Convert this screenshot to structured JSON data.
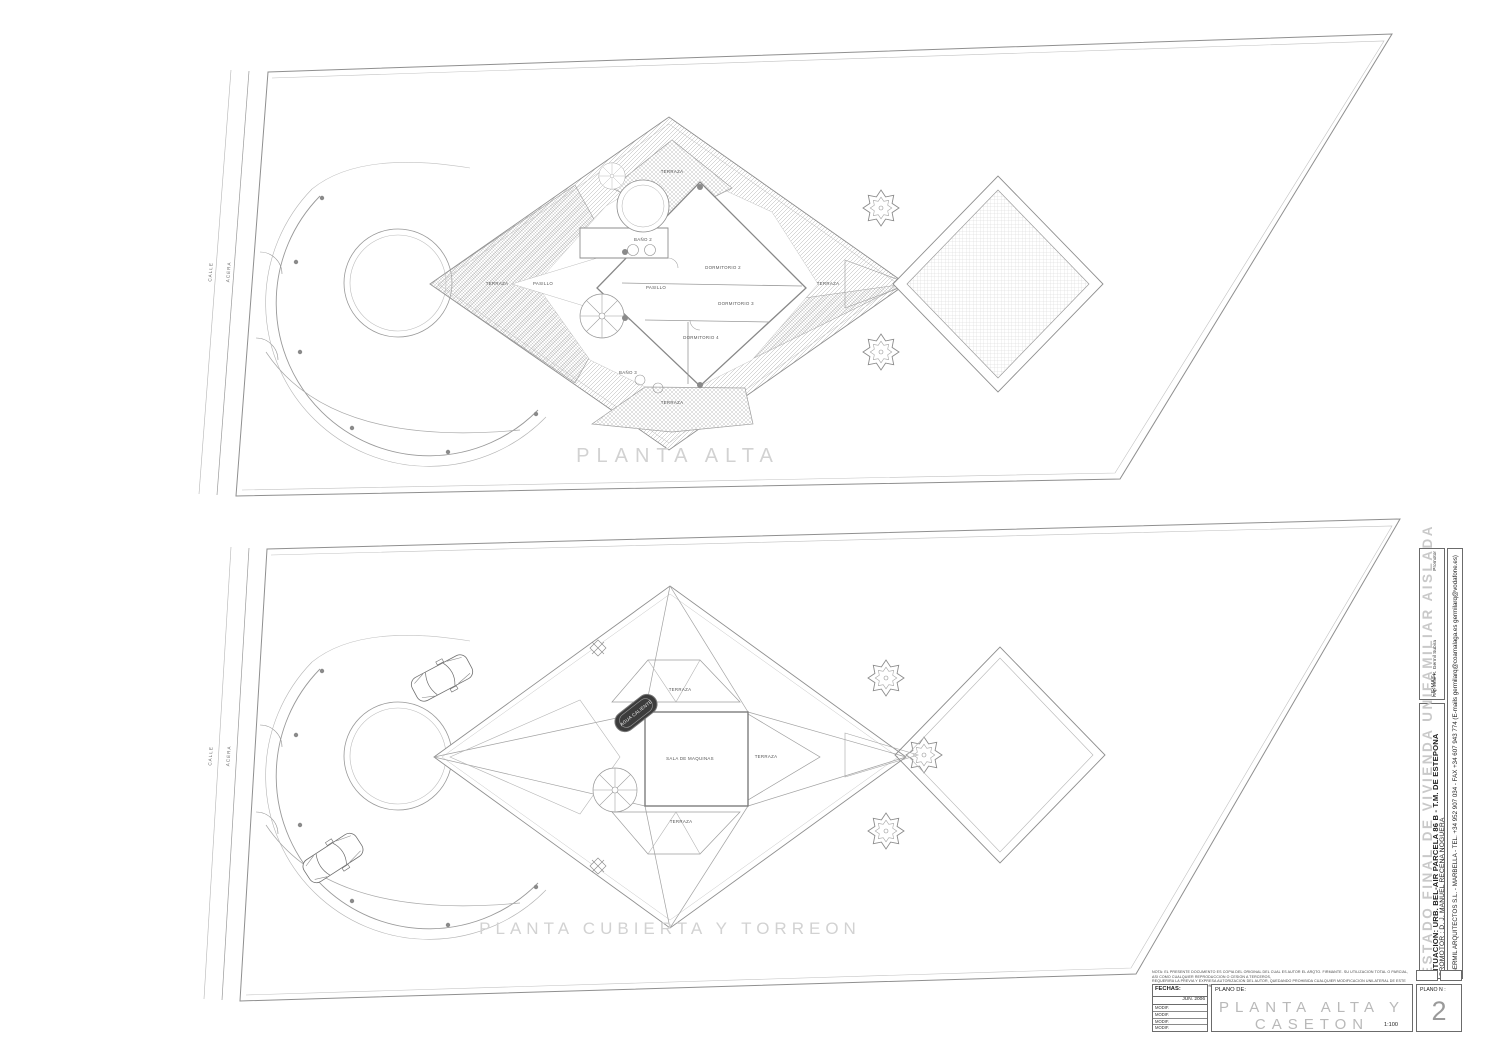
{
  "plans": {
    "upper": {
      "title": "PLANTA ALTA",
      "calle": "CALLE",
      "acera": "ACERA",
      "labels": {
        "terraza_left": "TERRAZA",
        "terraza_top": "TERRAZA",
        "terraza_right": "TERRAZA",
        "terraza_bottom": "TERRAZA",
        "pasillo_left": "PASILLO",
        "pasillo_center": "PASILLO",
        "bano2": "BAÑO 2",
        "bano3": "BAÑO 3",
        "dormitorio2": "DORMITORIO 2",
        "dormitorio3": "DORMITORIO 3",
        "dormitorio4": "DORMITORIO 4"
      }
    },
    "lower": {
      "title": "PLANTA CUBIERTA Y TORREON",
      "calle": "CALLE",
      "acera": "ACERA",
      "labels": {
        "terraza_top": "TERRAZA",
        "terraza_right": "TERRAZA",
        "terraza_bottom": "TERRAZA",
        "sala_maquinas": "SALA DE MAQUINAS",
        "agua_caliente": "AGUA CALIENTE"
      }
    }
  },
  "titleblock": {
    "watermark": "ESTADO FINAL DE VIVIENDA UNIFAMILIAR AISLADA",
    "situacion": "SITUACION:  URB. BEL-AIR PARCELA 86 B - T.M. DE ESTEPONA",
    "promotor": "PROMOTOR :  D. J. MANUEL RECENA NOGUERA",
    "firm_line": "GERMIL ARQUITECTOS S.L.  -  MARBELLA  -  TEL. +34 952 907 034 - FAX +34 607 943 774   (E-mails  germilarq@coamalaga.es   germilarq@vodafone.es)",
    "firmas_label": "FIRMAS:",
    "architect_sign": "Arq. José R. Germil Subira",
    "promotor_sign": "Promotor",
    "fechas_label": "FECHAS:",
    "fecha_value": "JUN. 2006",
    "modif_rows": [
      "MODIF.",
      "MODIF.",
      "MODIF.",
      "MODIF."
    ],
    "plano_de_label": "PLANO DE:",
    "sheet_title": "PLANTA  ALTA  Y  CASETON",
    "scale": "1:100",
    "plano_n_label": "PLANO N :",
    "sheet_number": "2",
    "legal_line1": "NOTA: EL PRESENTE DOCUMENTO ES COPIA DEL ORIGINAL DEL CUAL ES AUTOR EL ARQTO. FIRMANTE. SU UTILIZACION TOTAL O PARCIAL, ASI COMO CUALQUIER REPRODUCCION O CESION A TERCEROS,",
    "legal_line2": "REQUERIRA LA PREVIA Y EXPRESA AUTORIZACION DEL AUTOR, QUEDANDO PROHIBIDA CUALQUIER MODIFICACION UNILATERAL DE ESTE DOCUMENTO QUE DE ESTA FORMA PARTE DEL PRESENTE PROYECTO"
  }
}
